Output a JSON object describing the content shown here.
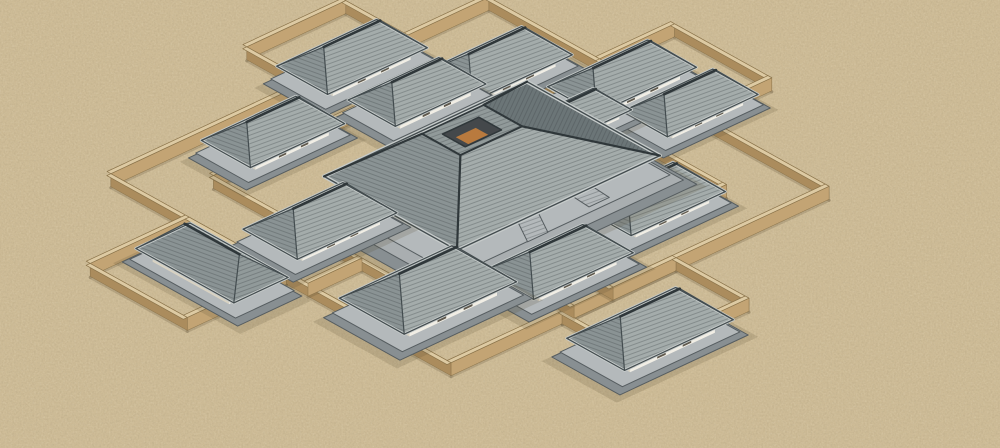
{
  "meta": {
    "description": "3D model render of a symmetric ancient Chinese ritual building complex: a large central hall with a square roof opening, surrounded by hip-roofed pavilions and stepped tan courtyard walls on sandy ground"
  },
  "palette": {
    "sand": "#cdbb96",
    "sand_speckle_dark": "#5c4a2e",
    "sand_speckle_light": "#efe3c2",
    "wall_front_light": "#c3a474",
    "wall_front_dark": "#ab8c5d",
    "wall_top": "#ddcaa3",
    "wall_edge": "#8a734a",
    "wall_shadow": "rgba(80,66,40,0.20)",
    "roof_light": "#a4acab",
    "roof_mid": "#8a9394",
    "roof_mid2": "#919a9a",
    "roof_back": "#7e8889",
    "roof_dark": "#6b7577",
    "roof_line": "#434c4f",
    "ridge": "#2f373a",
    "eave_light": "#c6cbca",
    "tile_line": "#3f4749",
    "white_wall": "#f1eee5",
    "white_wall_shade": "#d8d2c2",
    "door_dark": "#5f584c",
    "platform_top": "#b4b9bb",
    "platform_mid": "#a9aeb0",
    "platform_side": "#888f92",
    "platform_line": "#565d60",
    "hall_band": "#c6a065",
    "hall_floor": "#b97a3e",
    "opening_shadow": "#44484b",
    "building_shadow": "rgba(90,78,52,0.18)"
  },
  "scene": {
    "canvas": {
      "width": 1000,
      "height": 448
    },
    "iso": {
      "ox": 470,
      "oy": 193,
      "ux": 30,
      "uy": -14,
      "vx": 27,
      "vy": 15
    },
    "unit_u": [
      0.906,
      -0.423
    ],
    "unit_v": [
      0.874,
      0.486
    ],
    "walls": {
      "height": 13,
      "top_w": 4.5,
      "loops": [
        {
          "name": "outer-enclosure-wall",
          "rect": [
            -6.3,
            -6.3,
            6.3,
            6.3
          ]
        },
        {
          "name": "inner-enclosure-wall",
          "rect": [
            -4.5,
            -4.5,
            4.5,
            4.5
          ]
        },
        {
          "name": "west-bay-wall",
          "rect": [
            -9.6,
            -3.4,
            -6.3,
            0.2
          ]
        },
        {
          "name": "north-bay-wall",
          "rect": [
            0.3,
            -8.6,
            3.6,
            -6.3
          ]
        },
        {
          "name": "northeast-bay-wall",
          "rect": [
            6.3,
            -2.2,
            8.8,
            1.4
          ]
        },
        {
          "name": "south-bay-wall",
          "rect": [
            -2.6,
            6.3,
            1.2,
            9.0
          ]
        }
      ],
      "lines": [
        {
          "name": "west-corridor-wall-a",
          "pts": [
            [
              -4.5,
              -0.5
            ],
            [
              -6.3,
              -0.5
            ]
          ]
        },
        {
          "name": "west-corridor-wall-b",
          "pts": [
            [
              -4.5,
              1.0
            ],
            [
              -6.3,
              1.0
            ]
          ]
        },
        {
          "name": "north-corridor-wall",
          "pts": [
            [
              1.9,
              -4.5
            ],
            [
              1.9,
              -6.3
            ]
          ]
        },
        {
          "name": "east-corridor-wall",
          "pts": [
            [
              4.5,
              0.0
            ],
            [
              6.3,
              0.0
            ]
          ]
        },
        {
          "name": "south-corridor-wall-a",
          "pts": [
            [
              -0.9,
              4.5
            ],
            [
              -0.9,
              6.3
            ]
          ]
        },
        {
          "name": "south-corridor-wall-b",
          "pts": [
            [
              -2.2,
              4.5
            ],
            [
              -2.2,
              6.3
            ]
          ]
        }
      ]
    },
    "hall": {
      "name": "central-hall",
      "cx": 492,
      "cy": 166,
      "wa": 112,
      "wb": 76,
      "ring_cx": 472,
      "ring_cy": 130,
      "ring_wa": 34,
      "ring_wb": 22,
      "open_wa": 20,
      "open_wb": 13,
      "band_h": 13
    },
    "pavilions": [
      {
        "name": "pavilion-north-west-a",
        "cx": 352,
        "cy": 57,
        "wa": 55,
        "wb": 29,
        "bh": 10
      },
      {
        "name": "pavilion-north-west-b",
        "cx": 417,
        "cy": 92,
        "wa": 50,
        "wb": 27,
        "bh": 10
      },
      {
        "name": "pavilion-north",
        "cx": 497,
        "cy": 64,
        "wa": 55,
        "wb": 29,
        "bh": 10
      },
      {
        "name": "pavilion-north-east-a",
        "cx": 622,
        "cy": 77,
        "wa": 55,
        "wb": 28,
        "bh": 10
      },
      {
        "name": "pavilion-north-east-b",
        "cx": 690,
        "cy": 103,
        "wa": 50,
        "wb": 26,
        "bh": 9
      },
      {
        "name": "pavilion-north-east-inner",
        "cx": 576,
        "cy": 116,
        "wa": 40,
        "wb": 22,
        "bh": 8
      },
      {
        "name": "pavilion-west-upper",
        "cx": 273,
        "cy": 132,
        "wa": 52,
        "wb": 28,
        "bh": 10
      },
      {
        "name": "pavilion-west-lower",
        "cx": 320,
        "cy": 221,
        "wa": 55,
        "wb": 31,
        "bh": 10
      },
      {
        "name": "pavilion-far-west",
        "cx": 212,
        "cy": 263,
        "wa": 30,
        "wb": 56,
        "bh": 10
      },
      {
        "name": "pavilion-east",
        "cx": 652,
        "cy": 199,
        "wa": 52,
        "wb": 30,
        "bh": 10
      },
      {
        "name": "pavilion-south-right",
        "cx": 558,
        "cy": 262,
        "wa": 55,
        "wb": 29,
        "bh": 10
      },
      {
        "name": "pavilion-south-center",
        "cx": 428,
        "cy": 290,
        "wa": 62,
        "wb": 37,
        "bh": 12
      },
      {
        "name": "pavilion-south-east",
        "cx": 650,
        "cy": 329,
        "wa": 60,
        "wb": 33,
        "bh": 11
      }
    ]
  }
}
